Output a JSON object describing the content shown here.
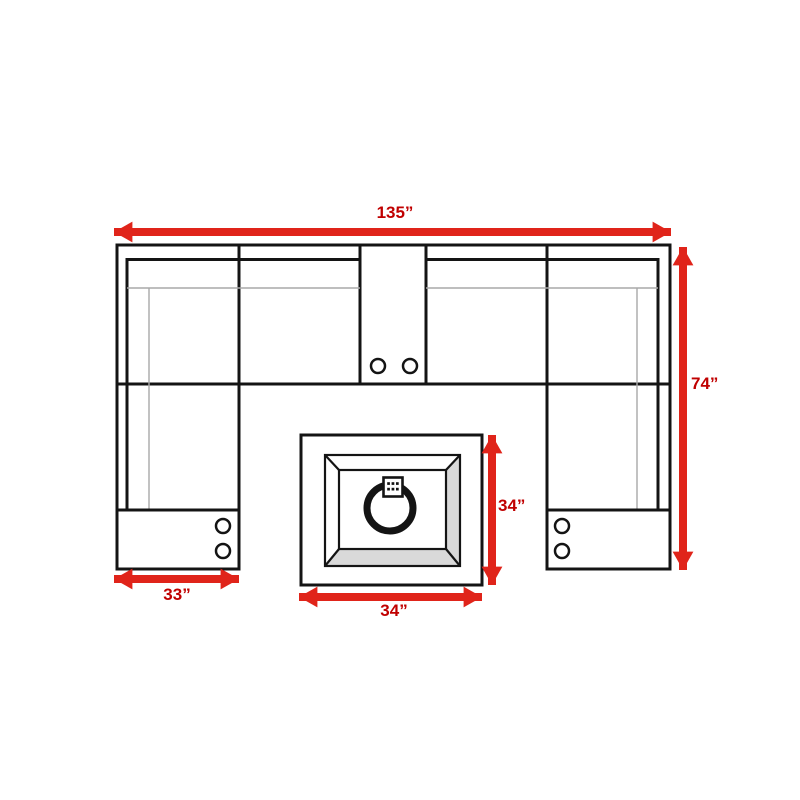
{
  "dimensions": {
    "overall_width": "135”",
    "overall_depth": "74”",
    "chaise_width": "33”",
    "fire_pit_width": "34”",
    "fire_pit_depth": "34”"
  },
  "colors": {
    "arrow": "#e0241a",
    "label": "#c00000",
    "line": "#141414",
    "soft_line": "#a9a9a9",
    "bevel": "#d9d9d9"
  }
}
